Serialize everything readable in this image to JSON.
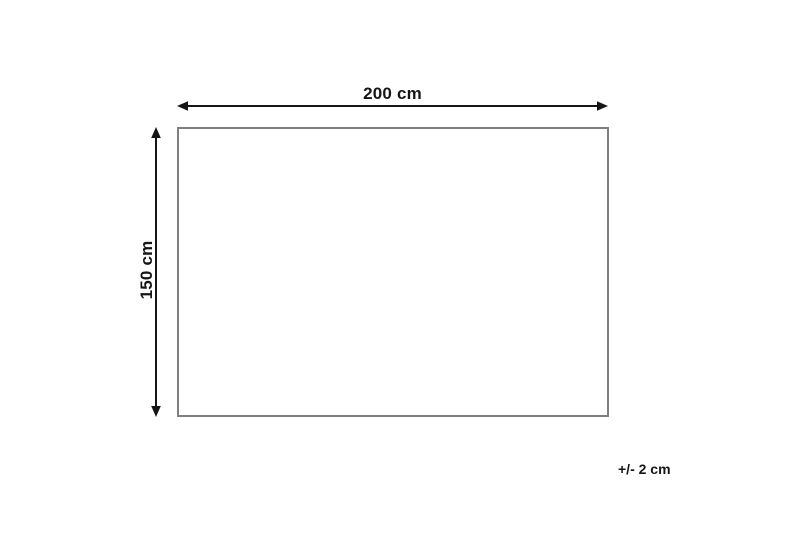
{
  "diagram": {
    "title": "product-dimension-diagram",
    "width_label": "200 cm",
    "height_label": "150 cm",
    "tolerance_label": "+/- 2 cm",
    "shape": "rectangle"
  },
  "colors": {
    "background": "#ffffff",
    "outline": "#7f7f7f",
    "arrow": "#161616",
    "text": "#161616"
  }
}
